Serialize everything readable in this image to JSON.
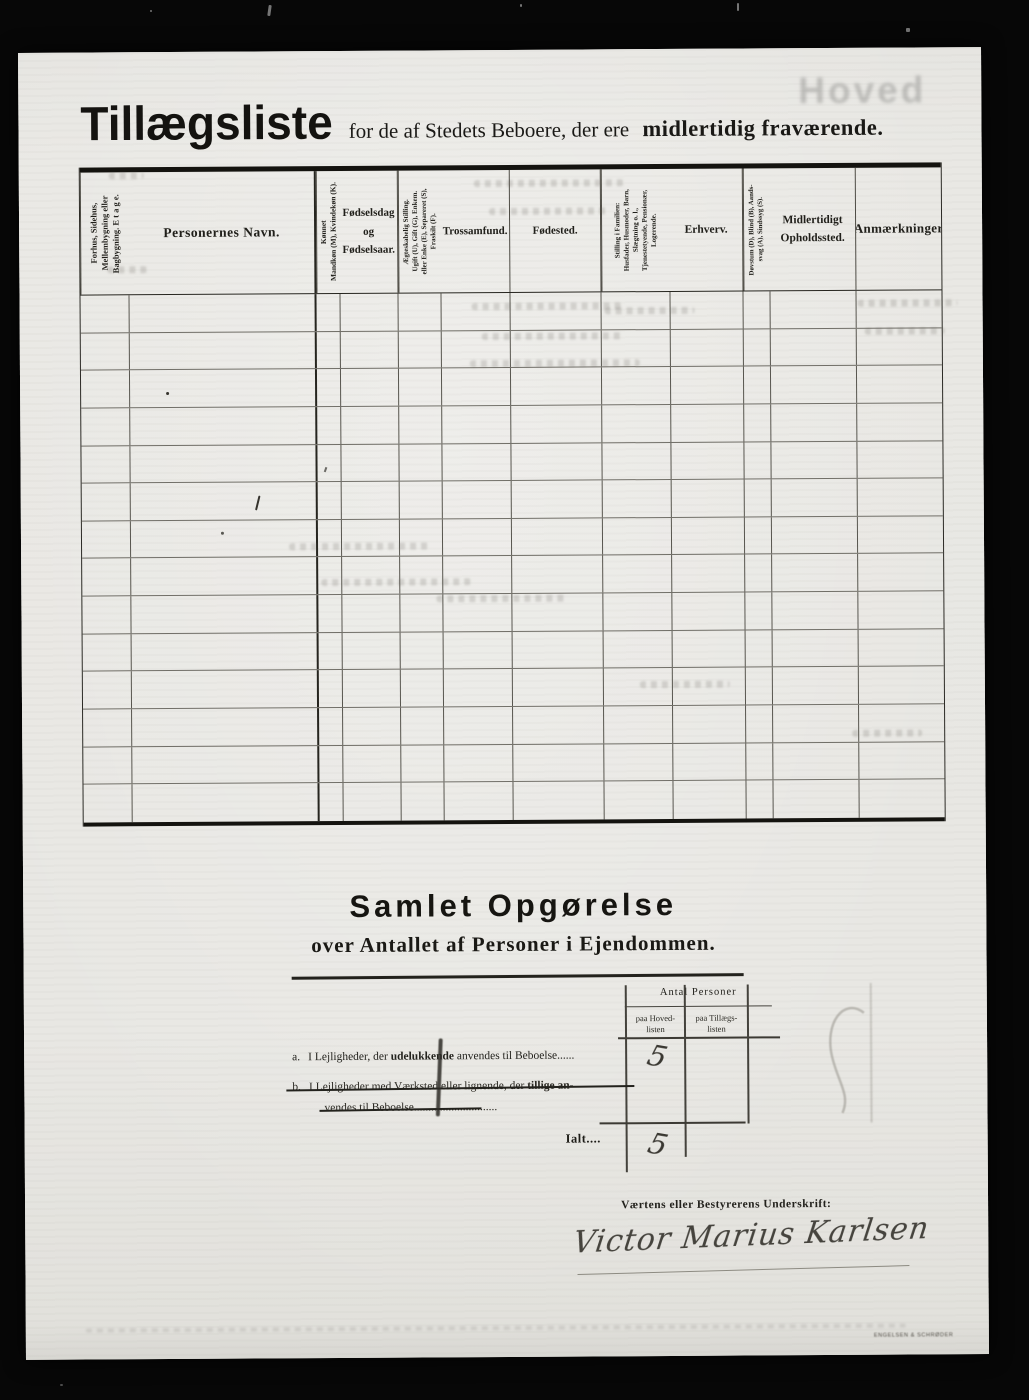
{
  "colors": {
    "paper": "#e8e7e3",
    "ink": "#1c1b18",
    "handwriting": "#3a3832",
    "background": "#070707"
  },
  "page": {
    "watermark": "Hoved",
    "printer_mark": "ENGELSEN & SCHRØDER"
  },
  "title": {
    "main": "Tillægsliste",
    "subtitle_regular": "for de af Stedets Beboere, der ere",
    "subtitle_bold": "midlertidig fraværende."
  },
  "table": {
    "columns": [
      {
        "label": "Forhus, Sidehus,\nMellembygning eller\nBagbygning.   E t a g e.",
        "rotated": true
      },
      {
        "label": "Personernes Navn.",
        "rotated": false
      },
      {
        "label": "Kønnet\nMandkøn (M), Kvindekøn (K).",
        "rotated": true
      },
      {
        "label": "Fødselsdag\nog\nFødselsaar.",
        "rotated": false
      },
      {
        "label": "Ægteskabelig Stilling.\nUgift (U), Gift (G), Enkem.\neller Enke (E), Separeret (S),\nFraskilt (F).",
        "rotated": true
      },
      {
        "label": "Trossamfund.",
        "rotated": false
      },
      {
        "label": "Fødested.",
        "rotated": false
      },
      {
        "label": "Stilling i Familien:\nHusfader, Husmoder, Barn,\nSlægtning o. l.,\nTjenestetyende, Pensionær,\nLogerende.",
        "rotated": true
      },
      {
        "label": "Erhverv.",
        "rotated": false
      },
      {
        "label": "Døvstum (D), Blind (B), Aands-\nsvag (A), Sindssyg (S).",
        "rotated": true
      },
      {
        "label": "Midlertidigt\nOpholdssted.",
        "rotated": false
      },
      {
        "label": "Anmærkninger",
        "rotated": false
      }
    ],
    "body_row_count": 14
  },
  "summary": {
    "heading": "Samlet Opgørelse",
    "subheading": "over Antallet af Personer i Ejendommen.",
    "mini_table": {
      "header": "Antal Personer",
      "col_hoved": "paa Hoved-\nlisten",
      "col_tillaegs": "paa Tillægs-\nlisten"
    },
    "values": {
      "hoved": "5",
      "ialt": "5"
    },
    "line_a": {
      "marker": "a.",
      "pre": "I Lejligheder, der ",
      "bold": "udelukkende",
      "post": " anvendes til Beboelse",
      "leaders": "......"
    },
    "line_b": {
      "marker": "b.",
      "pre": "I Lejligheder med Værksted eller lignende, der ",
      "bold": "tillige an-",
      "cont": "vendes til Beboelse",
      "leaders": "............................."
    },
    "ialt_label": "Ialt...."
  },
  "signature": {
    "label": "Værtens eller Bestyrerens Underskrift:",
    "name": "Victor Marius Karlsen"
  }
}
